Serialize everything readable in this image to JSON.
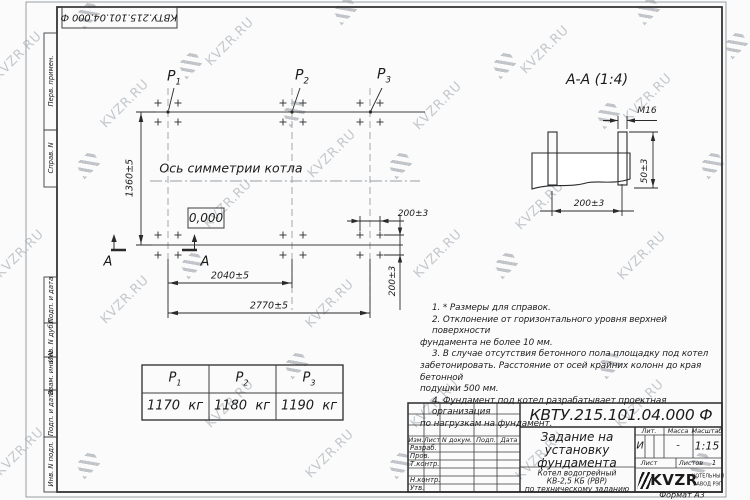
{
  "colors": {
    "line": "#2a2a2a",
    "wm_text": "#c3c8cd",
    "wm_icon": "#9aa1a8",
    "paper": "#fbfbfb"
  },
  "sheet": {
    "doc_number": "КВТУ.215.101.04.000  Ф",
    "format_label": "Формат А3",
    "margin_labels": [
      "Перв. примен.",
      "Справ. N",
      "Подп. и дата",
      "Инв. N дубл.",
      "Взам. инв. N",
      "Подп. и дата",
      "Инв. N подл."
    ]
  },
  "plan": {
    "p_labels": [
      {
        "name": "P",
        "sub": "1"
      },
      {
        "name": "P",
        "sub": "2"
      },
      {
        "name": "P",
        "sub": "3"
      }
    ],
    "axis_label": "Ось симметрии котла",
    "elevation": "0,000",
    "dim_height": "1360±5",
    "dim_width_mid": "2040±5",
    "dim_width_total": "2770±5",
    "dim_bolt_x": "200±3",
    "dim_bolt_y": "200±3",
    "section_letter": "А"
  },
  "section": {
    "title": "А-А  (1:4)",
    "bolt_label": "М16",
    "dim_protrusion": "50±3",
    "dim_spacing": "200±3"
  },
  "notes": {
    "lines": [
      {
        "indent": true,
        "text": "1.  * Размеры для справок."
      },
      {
        "indent": true,
        "text": "2.  Отклонение от горизонтального уровня верхней поверхности"
      },
      {
        "indent": false,
        "text": "фундамента не более 10 мм."
      },
      {
        "indent": true,
        "text": "3.  В случае отсутствия бетонного пола площадку под котел"
      },
      {
        "indent": false,
        "text": "забетонировать. Расстояние от осей крайних колонн до края бетонной"
      },
      {
        "indent": false,
        "text": "подушки 500 мм."
      },
      {
        "indent": true,
        "text": "4.  Фундамент под котел разрабатывает проектная организация"
      },
      {
        "indent": false,
        "text": "по нагрузкам на фундамент."
      }
    ]
  },
  "load_table": {
    "headers": [
      {
        "name": "P",
        "sub": "1"
      },
      {
        "name": "P",
        "sub": "2"
      },
      {
        "name": "P",
        "sub": "3"
      }
    ],
    "values": [
      {
        "value": "1170",
        "unit": "кг"
      },
      {
        "value": "1180",
        "unit": "кг"
      },
      {
        "value": "1190",
        "unit": "кг"
      }
    ]
  },
  "title_block": {
    "doc_number": "КВТУ.215.101.04.000  Ф",
    "title_lines": [
      "Задание на",
      "установку",
      "фундамента"
    ],
    "product_lines": [
      "Котел водогрейный",
      "КВ-2,5 КБ (РВР)",
      "по техническому заданию"
    ],
    "rev_headers": [
      "Изм.",
      "Лист",
      "N докум.",
      "Подп.",
      "Дата"
    ],
    "roles": [
      "Разраб.",
      "Пров.",
      "Т.контр.",
      "",
      "Н.контр.",
      "Утв."
    ],
    "lit_label": "Лит.",
    "mass_label": "Масса",
    "scale_label": "Масштаб",
    "lit_value": "И",
    "mass_value": "-",
    "scale_value": "1:15",
    "sheet_label": "Лист",
    "sheets_label": "Листов",
    "sheets_value": "1",
    "logo_text": "KVZR",
    "logo_caption_lines": [
      "КОТЕЛЬНЫЙ",
      "ЗАВОД РЭП"
    ]
  },
  "watermark": {
    "text": "KVZR.RU",
    "items": [
      {
        "t": "i",
        "x": 88,
        "y": 14
      },
      {
        "t": "i",
        "x": 345,
        "y": 10
      },
      {
        "t": "i",
        "x": 648,
        "y": 10
      },
      {
        "t": "i",
        "x": 736,
        "y": 44
      },
      {
        "t": "i",
        "x": 190,
        "y": 64
      },
      {
        "t": "i",
        "x": 504,
        "y": 64
      },
      {
        "t": "i",
        "x": 294,
        "y": 112
      },
      {
        "t": "i",
        "x": 608,
        "y": 114
      },
      {
        "t": "i",
        "x": 88,
        "y": 164
      },
      {
        "t": "i",
        "x": 400,
        "y": 164
      },
      {
        "t": "i",
        "x": 712,
        "y": 164
      },
      {
        "t": "i",
        "x": 192,
        "y": 264
      },
      {
        "t": "i",
        "x": 506,
        "y": 264
      },
      {
        "t": "i",
        "x": 296,
        "y": 364
      },
      {
        "t": "i",
        "x": 610,
        "y": 364
      },
      {
        "t": "i",
        "x": 88,
        "y": 464
      },
      {
        "t": "i",
        "x": 400,
        "y": 464
      },
      {
        "t": "i",
        "x": 700,
        "y": 464
      },
      {
        "t": "t",
        "x": 18,
        "y": 56
      },
      {
        "t": "t",
        "x": 230,
        "y": 42
      },
      {
        "t": "t",
        "x": 545,
        "y": 50
      },
      {
        "t": "t",
        "x": 648,
        "y": 98
      },
      {
        "t": "t",
        "x": 125,
        "y": 104
      },
      {
        "t": "t",
        "x": 438,
        "y": 106
      },
      {
        "t": "t",
        "x": 332,
        "y": 154
      },
      {
        "t": "t",
        "x": 228,
        "y": 204
      },
      {
        "t": "t",
        "x": 540,
        "y": 206
      },
      {
        "t": "t",
        "x": 20,
        "y": 254
      },
      {
        "t": "t",
        "x": 438,
        "y": 254
      },
      {
        "t": "t",
        "x": 642,
        "y": 256
      },
      {
        "t": "t",
        "x": 125,
        "y": 300
      },
      {
        "t": "t",
        "x": 330,
        "y": 304
      },
      {
        "t": "t",
        "x": 230,
        "y": 404
      },
      {
        "t": "t",
        "x": 435,
        "y": 404
      },
      {
        "t": "t",
        "x": 640,
        "y": 404
      },
      {
        "t": "t",
        "x": 20,
        "y": 452
      },
      {
        "t": "t",
        "x": 330,
        "y": 454
      },
      {
        "t": "t",
        "x": 540,
        "y": 456
      }
    ]
  }
}
